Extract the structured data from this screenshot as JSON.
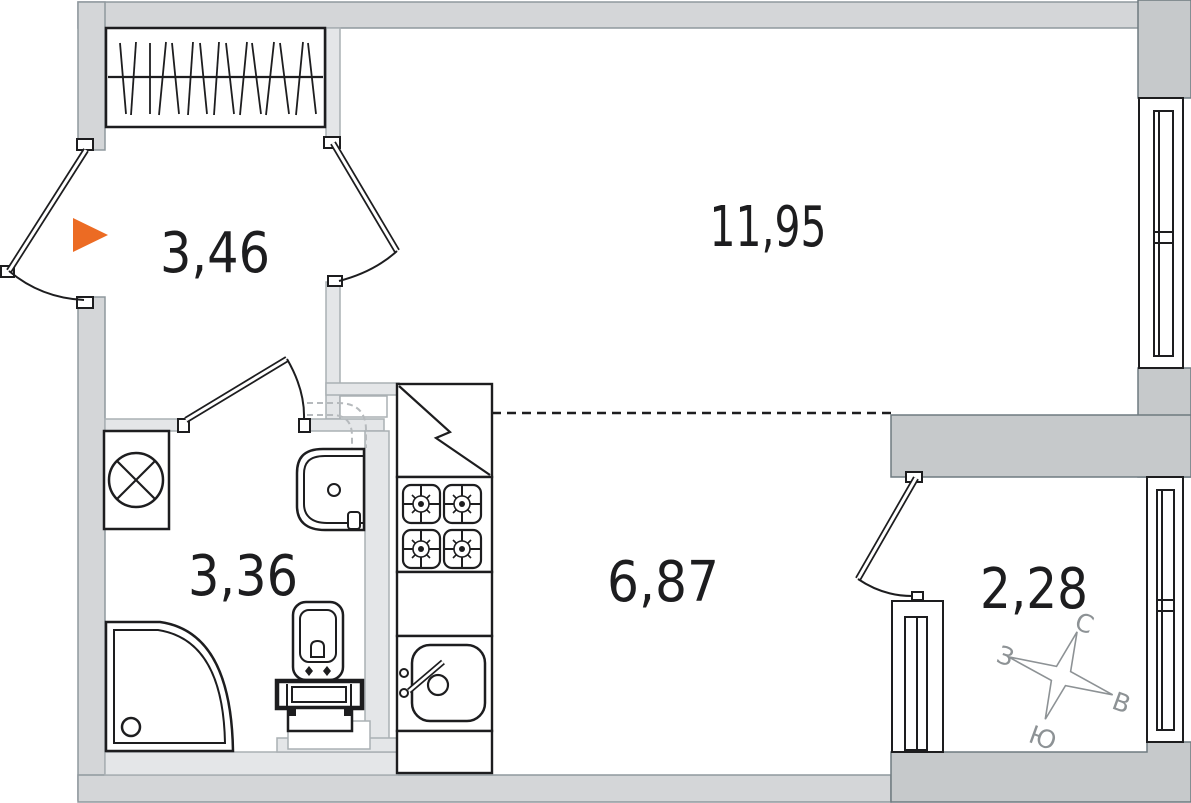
{
  "plan": {
    "title": "studio-apartment-floor-plan",
    "rooms": {
      "hallway": {
        "label": "3,46"
      },
      "living_room": {
        "label": "11,95"
      },
      "bathroom": {
        "label": "3,36"
      },
      "kitchen": {
        "label": "6,87"
      },
      "balcony": {
        "label": "2,28"
      }
    },
    "compass": {
      "north": "С",
      "east": "В",
      "south": "Ю",
      "west": "З"
    },
    "colors": {
      "entry_marker": "#EC6B23",
      "wall_outer": "#d4d6d8",
      "wall_bearing": "#c6c9cb",
      "wall_partition": "#e4e6e8",
      "line": "#1d1d1f",
      "compass": "#8d9295"
    },
    "fixtures": {
      "hallway": [
        "wardrobe"
      ],
      "bathroom": [
        "washing-machine",
        "sink",
        "shower",
        "toilet"
      ],
      "kitchen": [
        "fridge",
        "stove",
        "counter",
        "kitchen-sink"
      ],
      "windows": [
        "living-room-window",
        "balcony-side-window",
        "balcony-kitchen-window"
      ],
      "doors": [
        "entrance-door",
        "living-room-door",
        "bathroom-door",
        "balcony-door"
      ]
    }
  }
}
